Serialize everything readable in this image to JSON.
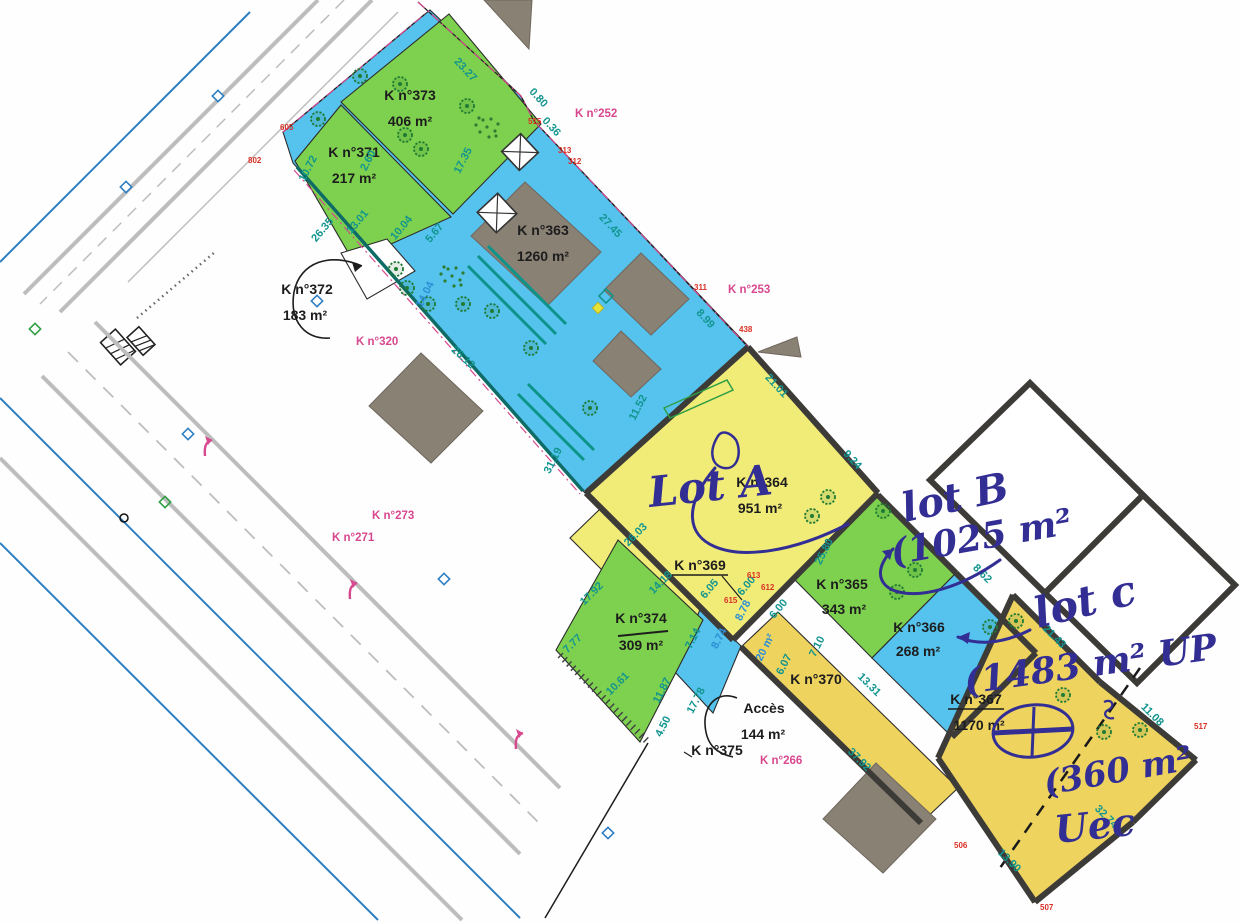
{
  "document": {
    "kind": "plan cadastral de division (scan annoté)"
  },
  "colors": {
    "parcel_blue": "#55c3ee",
    "parcel_green": "#7ed14e",
    "parcel_yellow": "#f1ec78",
    "parcel_yellow_dark": "#eed35f",
    "building_grey": "#8a8175",
    "dim_teal": "#12958f",
    "dim_blue": "#2d8fd5",
    "ref_pink": "#d8488f",
    "point_red": "#d93025",
    "ink_blue": "#332e94",
    "boundary_dark": "#3d3b37",
    "road_grey": "#bdbdbd",
    "line_blue": "#2d7fc2",
    "line_teal": "#0e6b66",
    "tree_green": "#1f7a33"
  },
  "parcels": [
    {
      "id": "k373",
      "ref": "K n°373",
      "area": "406 m²",
      "color": "green"
    },
    {
      "id": "k371",
      "ref": "K n°371",
      "area": "217 m²",
      "color": "green"
    },
    {
      "id": "k363",
      "ref": "K n°363",
      "area": "1260 m²",
      "color": "blue"
    },
    {
      "id": "k372",
      "ref": "K n°372",
      "area": "183 m²",
      "color": "white"
    },
    {
      "id": "k364",
      "ref": "K n°364",
      "area": "951 m²",
      "color": "yellow"
    },
    {
      "id": "k369",
      "ref": "K n°369",
      "area": "",
      "color": "yellow"
    },
    {
      "id": "k374",
      "ref": "K n°374",
      "area": "309 m²",
      "color": "green"
    },
    {
      "id": "k365",
      "ref": "K n°365",
      "area": "343 m²",
      "color": "green"
    },
    {
      "id": "k366",
      "ref": "K n°366",
      "area": "268 m²",
      "color": "blue"
    },
    {
      "id": "k370",
      "ref": "K n°370",
      "area": "",
      "color": "yellow"
    },
    {
      "id": "k367",
      "ref": "K n°367",
      "area": "1170 m²",
      "color": "yellow"
    },
    {
      "id": "k375",
      "ref": "K n°375",
      "area": "",
      "color": "white"
    },
    {
      "id": "acces",
      "ref": "Accès",
      "area": "144 m²",
      "color": "white"
    }
  ],
  "neighbor_refs": [
    "K n°252",
    "K n°253",
    "K n°320",
    "K n°273",
    "K n°271",
    "K n°266"
  ],
  "handwriting": {
    "lot_a": "Lot A",
    "lot_b": "lot B",
    "lot_b_area": "(1025 m²",
    "lot_c": "lot c",
    "lot_c_area": "(1483 m² UP",
    "lot_c_division_area": "(360 m²",
    "lot_c_division_name": "Uec"
  },
  "dimensions": [
    "23.27",
    "0.80",
    "0.36",
    "17.35",
    "27.45",
    "8.99",
    "26.35",
    "13.01",
    "10.04",
    "5.67",
    "10.72",
    "2.60",
    "14.04",
    "26.12",
    "11.52",
    "31.19",
    "21.01",
    "9.24",
    "25.80",
    "26.03",
    "14.18",
    "6.05",
    "6.00",
    "6.00",
    "8.78",
    "8.74",
    "7.14",
    "20 m²",
    "17.92",
    "7.77",
    "10.61",
    "11.87",
    "17.78",
    "4.50",
    "6.07",
    "7.10",
    "13.31",
    "8.62",
    "21.43",
    "11.08",
    "37.92",
    "13.90",
    "32.74"
  ],
  "point_numbers": [
    "515",
    "313",
    "312",
    "311",
    "438",
    "605",
    "802",
    "613",
    "612",
    "615",
    "506",
    "507",
    "517"
  ]
}
